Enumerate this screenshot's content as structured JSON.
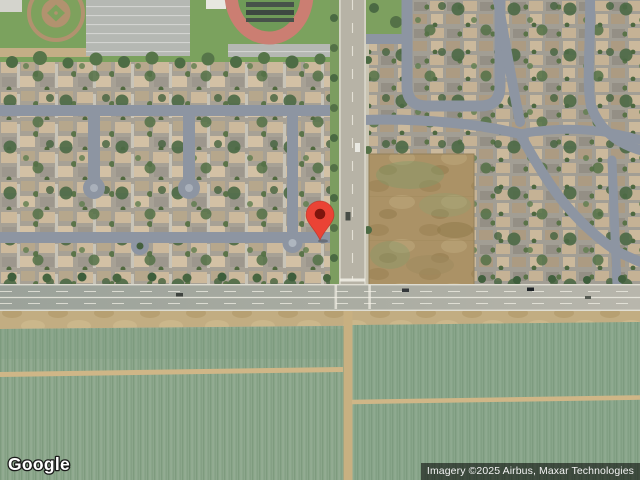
{
  "map": {
    "view_type": "satellite",
    "marker": {
      "color": "#EA4335",
      "inner_color": "#7E150D",
      "x": 320,
      "y": 240
    }
  },
  "branding": {
    "logo_text": "Google"
  },
  "attribution": {
    "text": "Imagery ©2025 Airbus, Maxar Technologies"
  },
  "colors": {
    "crop_field_green": "#8CA78C",
    "dirt_tan": "#C2AD82",
    "vacant_lot_brown": "#AB9266",
    "arterial_road_gray": "#B7B3A6",
    "residential_street_slate": "#8D95A2",
    "park_grass_green": "#7BA25E",
    "track_pink": "#CB7E72",
    "attribution_bg": "rgba(0,0,0,0.55)"
  }
}
